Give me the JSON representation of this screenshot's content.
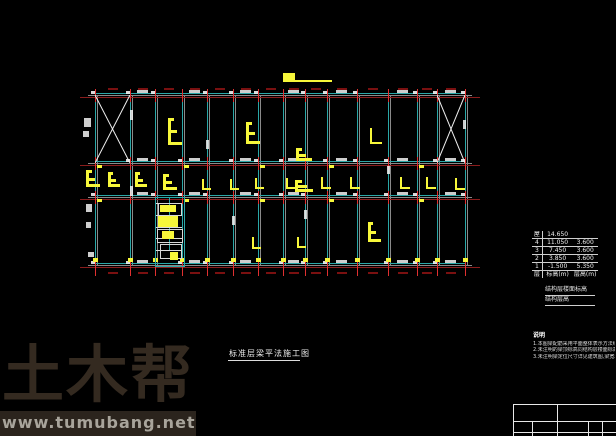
{
  "canvas": {
    "width": 616,
    "height": 436,
    "background": "#000000"
  },
  "watermark": {
    "logo": "土木帮",
    "url": "www.tumubang.net"
  },
  "drawing_title": {
    "text": "标准层梁平法施工图"
  },
  "floor_table": {
    "header": {
      "floor": "屋面",
      "elevation": "14.650",
      "height": ""
    },
    "rows": [
      [
        "4",
        "11.050",
        "3.600"
      ],
      [
        "3",
        "7.450",
        "3.600"
      ],
      [
        "2",
        "3.850",
        "3.600"
      ],
      [
        "1",
        "-1.500",
        "5.350"
      ]
    ],
    "footer": {
      "floor": "层号",
      "elevation": "标高(m)",
      "height": "层高(m)"
    },
    "caption_line1": "结构层楼面标高",
    "caption_line2": "结构层高"
  },
  "notes": {
    "heading": "说明",
    "lines": [
      "1.本图梁配筋采用平面整体表示方法绘制,详见图集16G101-1。",
      "2.未注明的梁顶标高同结构层楼面标高。",
      "3.未注明梁定位尺寸详见建筑图,梁宽均为300mm。"
    ]
  },
  "plan": {
    "x_start": 88,
    "x_end": 472,
    "columns_x": [
      95,
      130,
      155,
      182,
      207,
      233,
      258,
      283,
      305,
      327,
      357,
      388,
      417,
      437,
      465
    ],
    "rows_y": [
      95,
      163,
      197,
      265
    ],
    "colors": {
      "beam": "#2aa7a7",
      "gray": "#8a8a8a",
      "axis": "#8a1c1c",
      "tick": "#e03030",
      "yellow": "#f7f73a",
      "white": "#f2f2f2",
      "dim": "#7a1010"
    },
    "x_braces": [
      {
        "x1": 95,
        "y1": 95,
        "x2": 130,
        "y2": 163
      },
      {
        "x1": 437,
        "y1": 95,
        "x2": 465,
        "y2": 163
      }
    ],
    "glyphs": [
      {
        "t": "step",
        "x": 168,
        "y": 118,
        "w": 14,
        "h": 27
      },
      {
        "t": "step",
        "x": 246,
        "y": 122,
        "w": 14,
        "h": 22
      },
      {
        "t": "L",
        "x": 370,
        "y": 128,
        "w": 10,
        "h": 14
      },
      {
        "t": "bar",
        "x": 283,
        "y": 73,
        "w": 12,
        "h": 9
      },
      {
        "t": "bar",
        "x": 290,
        "y": 80,
        "w": 42,
        "h": 2
      },
      {
        "t": "step",
        "x": 296,
        "y": 148,
        "w": 16,
        "h": 13
      },
      {
        "t": "step",
        "x": 86,
        "y": 170,
        "w": 14,
        "h": 17
      },
      {
        "t": "step",
        "x": 108,
        "y": 172,
        "w": 12,
        "h": 15
      },
      {
        "t": "step",
        "x": 135,
        "y": 172,
        "w": 12,
        "h": 15
      },
      {
        "t": "step",
        "x": 163,
        "y": 174,
        "w": 14,
        "h": 16
      },
      {
        "t": "L",
        "x": 202,
        "y": 179,
        "w": 7,
        "h": 9
      },
      {
        "t": "L",
        "x": 230,
        "y": 179,
        "w": 7,
        "h": 9
      },
      {
        "t": "L",
        "x": 255,
        "y": 178,
        "w": 7,
        "h": 9
      },
      {
        "t": "L",
        "x": 286,
        "y": 178,
        "w": 7,
        "h": 9
      },
      {
        "t": "step",
        "x": 295,
        "y": 180,
        "w": 18,
        "h": 12
      },
      {
        "t": "L",
        "x": 321,
        "y": 177,
        "w": 8,
        "h": 10
      },
      {
        "t": "L",
        "x": 350,
        "y": 177,
        "w": 8,
        "h": 10
      },
      {
        "t": "L",
        "x": 400,
        "y": 177,
        "w": 8,
        "h": 10
      },
      {
        "t": "L",
        "x": 426,
        "y": 177,
        "w": 8,
        "h": 10
      },
      {
        "t": "L",
        "x": 455,
        "y": 178,
        "w": 8,
        "h": 10
      },
      {
        "t": "step",
        "x": 368,
        "y": 222,
        "w": 13,
        "h": 20
      },
      {
        "t": "L",
        "x": 252,
        "y": 237,
        "w": 7,
        "h": 10
      },
      {
        "t": "L",
        "x": 297,
        "y": 237,
        "w": 7,
        "h": 9
      }
    ],
    "white_marks": [
      [
        84,
        118,
        7,
        9
      ],
      [
        83,
        131,
        6,
        6
      ],
      [
        86,
        204,
        6,
        8
      ],
      [
        86,
        222,
        5,
        6
      ],
      [
        88,
        252,
        6,
        5
      ],
      [
        130,
        110,
        3,
        10
      ],
      [
        130,
        186,
        3,
        10
      ],
      [
        206,
        140,
        3,
        9
      ],
      [
        304,
        210,
        3,
        9
      ],
      [
        387,
        166,
        3,
        8
      ],
      [
        232,
        216,
        3,
        9
      ],
      [
        463,
        120,
        3,
        9
      ]
    ],
    "stair": {
      "x": 155,
      "y": 197,
      "w": 28,
      "h": 68,
      "mid_x": 169,
      "h_lines": [
        203,
        215,
        227,
        238,
        250
      ],
      "yellow": [
        [
          160,
          205,
          16,
          7
        ],
        [
          158,
          216,
          20,
          11
        ],
        [
          162,
          231,
          12,
          8
        ],
        [
          170,
          252,
          8,
          8
        ]
      ],
      "boxes": [
        [
          158,
          203,
          22,
          11
        ],
        [
          157,
          229,
          24,
          12
        ],
        [
          160,
          244,
          20,
          13
        ]
      ]
    }
  },
  "title_block": {
    "h_lines": [
      [
        513,
        404,
        616
      ],
      [
        513,
        421,
        616
      ],
      [
        513,
        432,
        616
      ]
    ],
    "v_lines": [
      [
        513,
        404,
        436
      ],
      [
        557,
        404,
        436
      ],
      [
        532,
        421,
        436
      ],
      [
        588,
        421,
        436
      ],
      [
        602,
        421,
        436
      ]
    ]
  }
}
